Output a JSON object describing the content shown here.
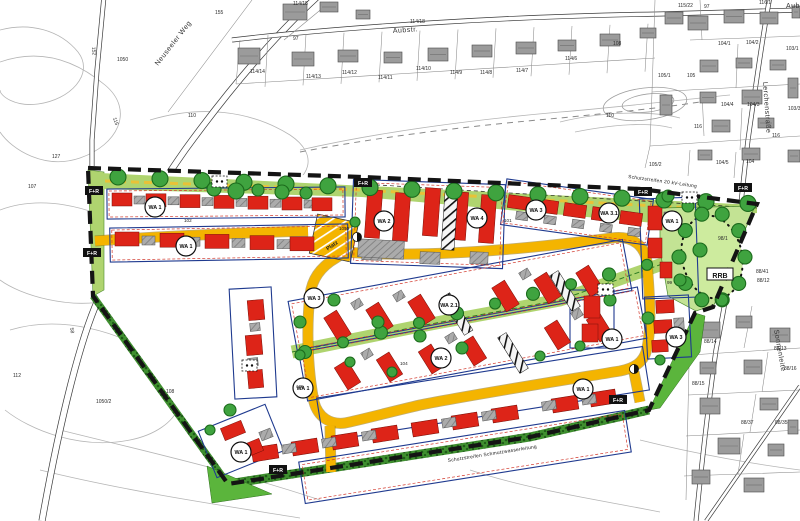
{
  "map": {
    "title_hint": "Bebauungsplan-Ausschnitt",
    "streets": [
      {
        "name": "Neuseeler Weg",
        "x": 158,
        "y": 66,
        "rot": -52
      },
      {
        "name": "Aubstr.",
        "x": 393,
        "y": 33,
        "rot": -4
      },
      {
        "name": "Aubstr.",
        "x": 786,
        "y": 8,
        "rot": 0
      },
      {
        "name": "Lerchenstraße",
        "x": 763,
        "y": 82,
        "rot": 86
      },
      {
        "name": "Sonnenleite",
        "x": 774,
        "y": 330,
        "rot": 80
      }
    ],
    "protection_strips": [
      {
        "text": "Schutzstreifen 20 kV-Leitung",
        "x": 628,
        "y": 178,
        "rot": 8
      },
      {
        "text": "Schutzstreifen Schmutzwasserleitung",
        "x": 448,
        "y": 462,
        "rot": -9
      }
    ],
    "zone_labels": [
      {
        "text": "WA 1",
        "x": 155,
        "y": 207
      },
      {
        "text": "WA 1",
        "x": 186,
        "y": 246
      },
      {
        "text": "WA 2",
        "x": 384,
        "y": 221
      },
      {
        "text": "WA 4",
        "x": 477,
        "y": 218
      },
      {
        "text": "WA 3",
        "x": 536,
        "y": 210
      },
      {
        "text": "WA 3.1",
        "x": 609,
        "y": 213
      },
      {
        "text": "WA 1",
        "x": 672,
        "y": 221
      },
      {
        "text": "WA 3",
        "x": 314,
        "y": 298
      },
      {
        "text": "WA 2.1",
        "x": 449,
        "y": 305
      },
      {
        "text": "WA 2",
        "x": 441,
        "y": 358
      },
      {
        "text": "WA 1",
        "x": 303,
        "y": 388
      },
      {
        "text": "WA 1",
        "x": 612,
        "y": 339
      },
      {
        "text": "WA 3",
        "x": 676,
        "y": 337
      },
      {
        "text": "WA 1",
        "x": 583,
        "y": 389
      },
      {
        "text": "WA 1",
        "x": 241,
        "y": 452
      }
    ],
    "path_labels": [
      {
        "text": "F+R",
        "x": 94,
        "y": 191
      },
      {
        "text": "F+R",
        "x": 92,
        "y": 253
      },
      {
        "text": "F+R",
        "x": 363,
        "y": 183
      },
      {
        "text": "F+R",
        "x": 643,
        "y": 192
      },
      {
        "text": "F+R",
        "x": 743,
        "y": 188
      },
      {
        "text": "F+R",
        "x": 278,
        "y": 470
      },
      {
        "text": "F+R",
        "x": 618,
        "y": 400
      }
    ],
    "facilities": [
      {
        "text": "RRB",
        "x": 720,
        "y": 276
      },
      {
        "text": "Platz",
        "x": 333,
        "y": 247,
        "rot": -35
      }
    ],
    "road_numbers": [
      {
        "text": "102",
        "x": 184,
        "y": 222
      },
      {
        "text": "101",
        "x": 504,
        "y": 222
      },
      {
        "text": "104",
        "x": 400,
        "y": 365
      },
      {
        "text": "105",
        "x": 296,
        "y": 388
      },
      {
        "text": "99",
        "x": 667,
        "y": 284
      },
      {
        "text": "1050",
        "x": 339,
        "y": 230
      }
    ],
    "parcels": [
      {
        "text": "155",
        "x": 215,
        "y": 14
      },
      {
        "text": "1050",
        "x": 117,
        "y": 61
      },
      {
        "text": "110",
        "x": 188,
        "y": 117
      },
      {
        "text": "110",
        "x": 606,
        "y": 117
      },
      {
        "text": "152",
        "x": 92,
        "y": 47,
        "rot": 85
      },
      {
        "text": "115",
        "x": 113,
        "y": 118,
        "rot": 72
      },
      {
        "text": "127",
        "x": 52,
        "y": 158
      },
      {
        "text": "107",
        "x": 28,
        "y": 188
      },
      {
        "text": "112",
        "x": 13,
        "y": 377
      },
      {
        "text": "108",
        "x": 166,
        "y": 393
      },
      {
        "text": "1050/2",
        "x": 96,
        "y": 403
      },
      {
        "text": "58",
        "x": 70,
        "y": 328,
        "rot": 80
      },
      {
        "text": "114/15",
        "x": 293,
        "y": 5
      },
      {
        "text": "114/18",
        "x": 410,
        "y": 23
      },
      {
        "text": "97",
        "x": 293,
        "y": 40
      },
      {
        "text": "97",
        "x": 704,
        "y": 8
      },
      {
        "text": "115/22",
        "x": 678,
        "y": 7
      },
      {
        "text": "116/1",
        "x": 759,
        "y": 4
      },
      {
        "text": "114/14",
        "x": 250,
        "y": 73
      },
      {
        "text": "114/13",
        "x": 306,
        "y": 78
      },
      {
        "text": "114/12",
        "x": 342,
        "y": 74
      },
      {
        "text": "114/11",
        "x": 378,
        "y": 79
      },
      {
        "text": "114/10",
        "x": 416,
        "y": 70
      },
      {
        "text": "114/9",
        "x": 450,
        "y": 74
      },
      {
        "text": "114/8",
        "x": 480,
        "y": 74
      },
      {
        "text": "114/7",
        "x": 516,
        "y": 72
      },
      {
        "text": "114/6",
        "x": 565,
        "y": 60
      },
      {
        "text": "108",
        "x": 613,
        "y": 45
      },
      {
        "text": "104/1",
        "x": 718,
        "y": 45
      },
      {
        "text": "104/2",
        "x": 746,
        "y": 44
      },
      {
        "text": "103/1",
        "x": 786,
        "y": 50
      },
      {
        "text": "105/1",
        "x": 658,
        "y": 77
      },
      {
        "text": "105",
        "x": 687,
        "y": 77
      },
      {
        "text": "104/4",
        "x": 721,
        "y": 106
      },
      {
        "text": "104/3",
        "x": 747,
        "y": 106
      },
      {
        "text": "103/3",
        "x": 788,
        "y": 110
      },
      {
        "text": "116",
        "x": 694,
        "y": 128
      },
      {
        "text": "116",
        "x": 772,
        "y": 137
      },
      {
        "text": "105/2",
        "x": 649,
        "y": 166
      },
      {
        "text": "104/5",
        "x": 716,
        "y": 164
      },
      {
        "text": "104",
        "x": 746,
        "y": 163
      },
      {
        "text": "98/1",
        "x": 718,
        "y": 240
      },
      {
        "text": "88/41",
        "x": 756,
        "y": 273
      },
      {
        "text": "88/12",
        "x": 757,
        "y": 282
      },
      {
        "text": "88/14",
        "x": 704,
        "y": 343
      },
      {
        "text": "88/13",
        "x": 774,
        "y": 350
      },
      {
        "text": "88/16",
        "x": 784,
        "y": 370
      },
      {
        "text": "88/15",
        "x": 692,
        "y": 385
      },
      {
        "text": "88/37",
        "x": 741,
        "y": 424
      },
      {
        "text": "88/35",
        "x": 775,
        "y": 424
      }
    ],
    "colors": {
      "planned_building": "#DD2418",
      "existing_building": "#9B9B9B",
      "road_yellow": "#F4B400",
      "green_strip": "#AFD46F",
      "hedge": "#3F8F2F",
      "green_wedge": "#5BB53C",
      "rrb_area": "#C3E394",
      "tree": "#3FA33F",
      "boundary": "#141414",
      "block_outline": "#1F3A8F",
      "building_limit": "#D23A2E"
    },
    "icons": {
      "tree": "green-circle",
      "playground": "dashed-white-square",
      "turning_point": "half-filled-circle",
      "path_marker": "black-box-white-text"
    }
  }
}
